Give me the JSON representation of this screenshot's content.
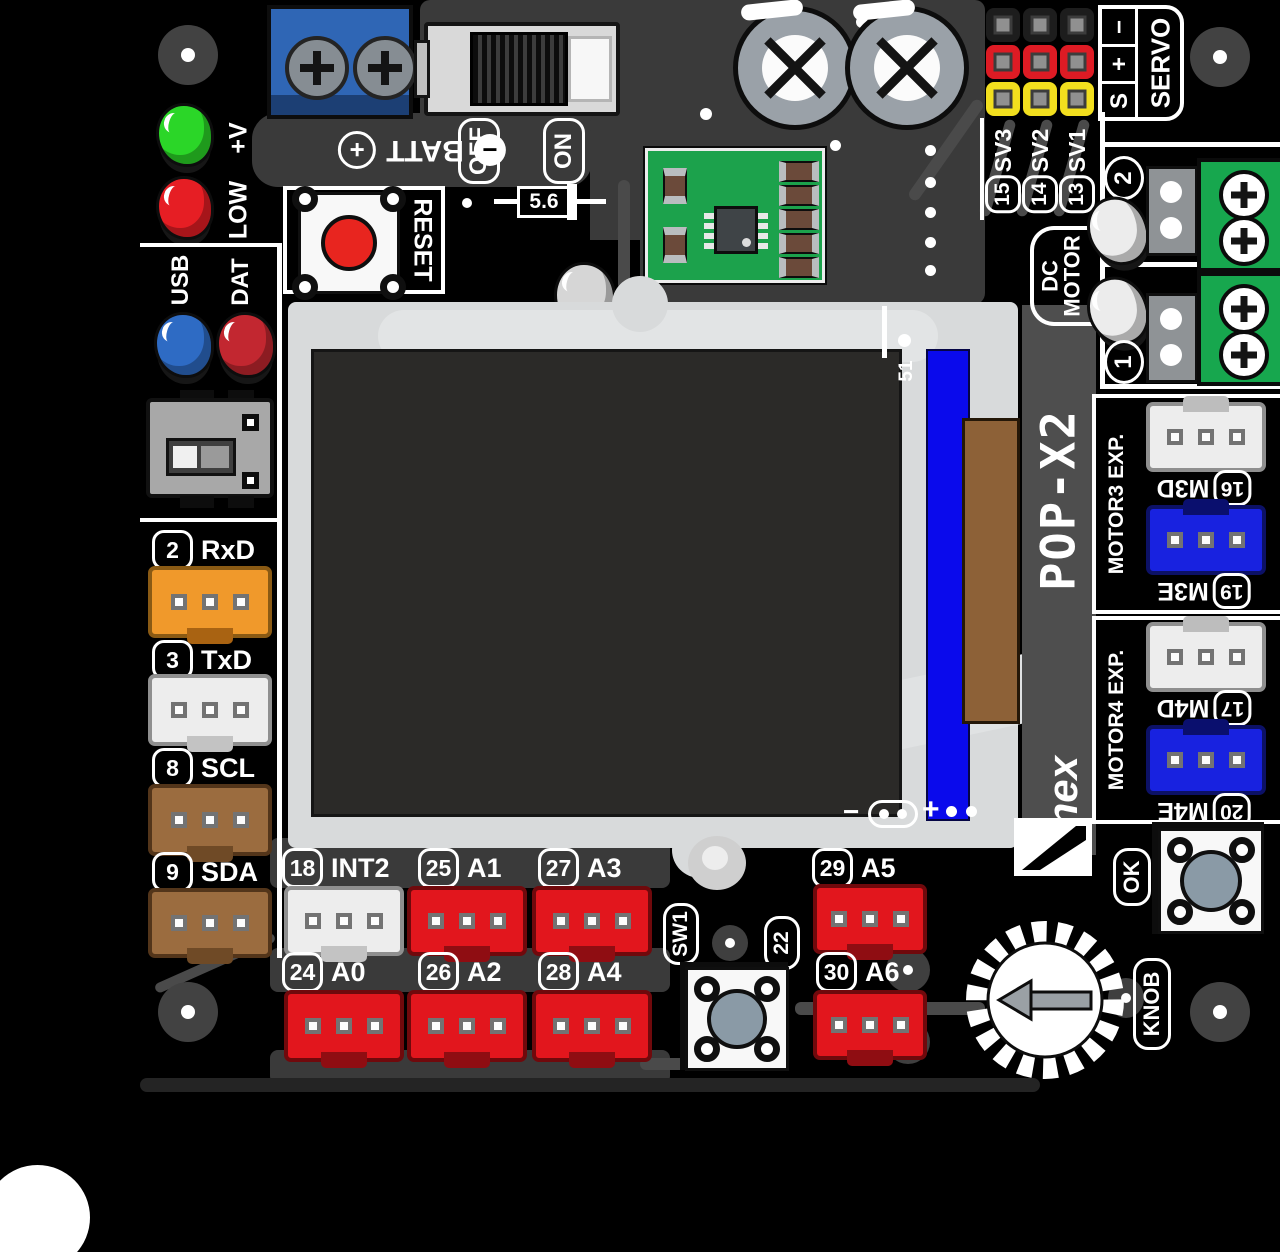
{
  "board": {
    "name": "POP-X2",
    "logo": "inex",
    "ref": "51"
  },
  "power": {
    "batt": "BATT",
    "plus": "+",
    "minus": "−",
    "off": "OFF",
    "on": "ON",
    "zener": "5.6",
    "reset": "RESET"
  },
  "leds": {
    "vplus": "+V",
    "low": "LOW",
    "usb": "USB",
    "dat": "DAT"
  },
  "servo": {
    "title": "SERVO",
    "sig": "S",
    "plus": "+",
    "minus": "−",
    "channels": [
      {
        "num": "15",
        "name": "SV3"
      },
      {
        "num": "14",
        "name": "SV2"
      },
      {
        "num": "13",
        "name": "SV1"
      }
    ]
  },
  "dc_motor": {
    "line1": "DC",
    "line2": "MOTOR",
    "ch": [
      {
        "num": "2"
      },
      {
        "num": "1"
      }
    ]
  },
  "motor_exp": [
    {
      "title": "MOTOR3 EXP.",
      "ports": [
        {
          "num": "16",
          "name": "M3D"
        },
        {
          "num": "19",
          "name": "M3E"
        }
      ]
    },
    {
      "title": "MOTOR4 EXP.",
      "ports": [
        {
          "num": "17",
          "name": "M4D"
        },
        {
          "num": "20",
          "name": "M4E"
        }
      ]
    }
  ],
  "left_ports": [
    {
      "num": "2",
      "name": "RxD"
    },
    {
      "num": "3",
      "name": "TxD"
    },
    {
      "num": "8",
      "name": "SCL"
    },
    {
      "num": "9",
      "name": "SDA"
    }
  ],
  "io_row1": [
    {
      "num": "18",
      "name": "INT2"
    },
    {
      "num": "25",
      "name": "A1"
    },
    {
      "num": "27",
      "name": "A3"
    }
  ],
  "io_row2": [
    {
      "num": "24",
      "name": "A0"
    },
    {
      "num": "26",
      "name": "A2"
    },
    {
      "num": "28",
      "name": "A4"
    }
  ],
  "io_right": [
    {
      "num": "29",
      "name": "A5"
    },
    {
      "num": "30",
      "name": "A6"
    }
  ],
  "controls": {
    "sw1": "SW1",
    "pin22": "22",
    "ok": "OK",
    "knob": "KNOB"
  },
  "lcd": {
    "minus": "−",
    "plus": "+"
  },
  "colors": {
    "pcb": "#000000",
    "panel": "#3a3a3a",
    "silkscreen": "#ffffff",
    "lcd_body": "#d8dadb",
    "screen": "#2b2a28",
    "tab_blue": "#0a0aec",
    "flex_brown": "#8d6137",
    "trimmer": "#2f66b5",
    "module_green": "#1ca24c",
    "terminal_green": "#17a74e",
    "conn_red": "#e2161d",
    "conn_orange": "#f0992b",
    "conn_white": "#ededed",
    "conn_brown": "#9b6c3f",
    "conn_blue": "#1822e0",
    "pin_black": "#1d1d1d",
    "pin_red": "#de1b24",
    "pin_yellow": "#f2df1e",
    "led_green": "#2bd628",
    "led_red": "#e61e24",
    "led_blue": "#2e6bc4",
    "led_dark_red": "#c22730"
  }
}
